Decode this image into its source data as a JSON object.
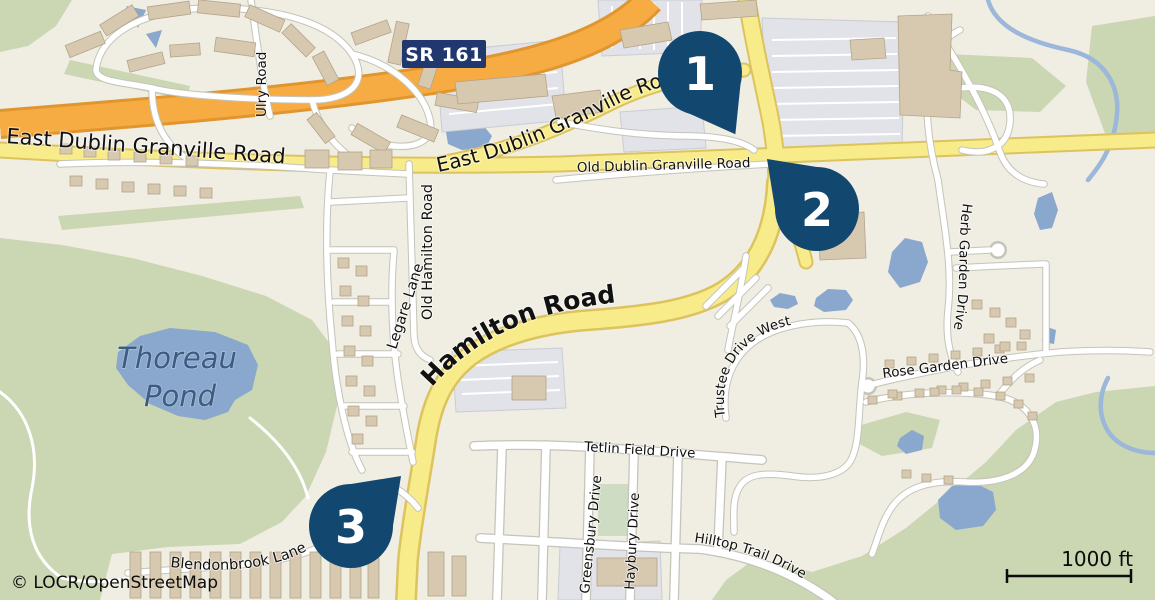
{
  "map": {
    "attribution": "© LOCR/OpenStreetMap",
    "scale_bar": {
      "label": "1000 ft"
    },
    "route_shield": {
      "label": "SR 161"
    },
    "markers": [
      {
        "number": "1"
      },
      {
        "number": "2"
      },
      {
        "number": "3"
      }
    ],
    "labels": {
      "east_dublin_left": "East Dublin Granville Road",
      "east_dublin_curved": "East Dublin Granville Road",
      "old_dublin": "Old Dublin Granville Road",
      "ulry": "Ulry Road",
      "old_hamilton": "Old Hamilton Road",
      "legare": "Legare Lane",
      "hamilton": "Hamilton Road",
      "thoreau_line1": "Thoreau",
      "thoreau_line2": "Pond",
      "herb_garden": "Herb Garden Drive",
      "rose_garden": "Rose Garden Drive",
      "trustee": "Trustee Drive West",
      "tetlin": "Tetlin Field Drive",
      "greensbury": "Greensbury Drive",
      "haybury": "Haybury Drive",
      "hilltop": "Hilltop Trail Drive",
      "blendonbrook": "Blendonbrook Lane"
    },
    "colors": {
      "land": "#f0ede2",
      "green": "#cbd6b2",
      "park_green": "#cddcc3",
      "water": "#8aa7cd",
      "stream": "#9bb7d9",
      "road_yellow": "#f8ec8a",
      "yellow_casing": "#dcc35e",
      "road_orange": "#f6ac43",
      "orange_casing": "#e0952e",
      "road_casing": "#c4c4ba",
      "building": "#d7c8b0",
      "building_outline": "#b3a489",
      "parking": "#e1e3e8",
      "marker": "#12486f",
      "shield": "#21386e",
      "label": "#111111",
      "pond_label": "#3c5c82"
    }
  }
}
